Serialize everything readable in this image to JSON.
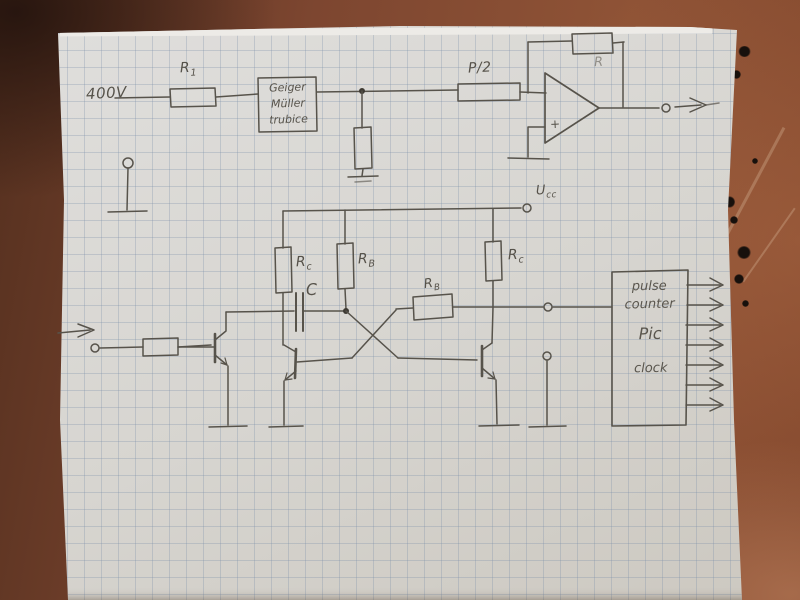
{
  "labels": {
    "hv": "400V",
    "r1": {
      "main": "R",
      "sub": "1"
    },
    "gm_tube": {
      "line1": "Geiger",
      "line2": "Müller",
      "line3": "trubice"
    },
    "p_half": "P/2",
    "r_feedback": "R",
    "opamp_plus": "+",
    "ucc": {
      "main": "U",
      "sub": "cc"
    },
    "rc_left": {
      "main": "R",
      "sub": "c"
    },
    "rb_vertical": {
      "main": "R",
      "sub": "B"
    },
    "rc_right": {
      "main": "R",
      "sub": "c"
    },
    "rb_horizontal": {
      "main": "R",
      "sub": "B"
    },
    "cap": "C",
    "counter_box": {
      "line1": "pulse",
      "line2": "counter",
      "line3": "Pic",
      "line4": "clock"
    }
  },
  "colors": {
    "background_rust": "#8f5336",
    "background_dark": "#55301f",
    "paper": "#d7d5d0",
    "grid_line": "#7a8ea8",
    "pencil": "#57534b"
  }
}
